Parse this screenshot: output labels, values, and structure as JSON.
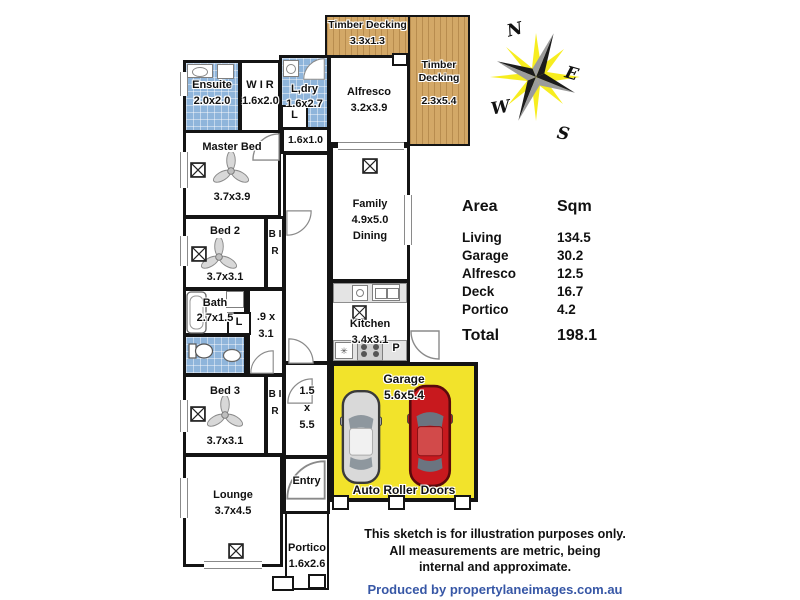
{
  "plan": {
    "deck_top": {
      "name": "Timber Decking",
      "dims": "3.3x1.3"
    },
    "deck_right": {
      "name": "Timber Decking",
      "dims": "2.3x5.4"
    },
    "alfresco": {
      "name": "Alfresco",
      "dims": "3.2x3.9"
    },
    "ensuite": {
      "name": "Ensuite",
      "dims": "2.0x2.0"
    },
    "wir": {
      "name": "W I R",
      "dims": "1.6x2.0"
    },
    "ldry": {
      "name": "L,dry",
      "dims": "1.6x2.7"
    },
    "linen1": {
      "name": "L"
    },
    "hall_a": {
      "dims": "1.6x1.0"
    },
    "master": {
      "name": "Master Bed",
      "dims": "3.7x3.9"
    },
    "family": {
      "name": "Family",
      "dims": "4.9x5.0",
      "extra": "Dining"
    },
    "bed2": {
      "name": "Bed 2",
      "dims": "3.7x3.1"
    },
    "bir1": {
      "name": "B I R"
    },
    "bath": {
      "name": "Bath",
      "dims": "2.7x1.5"
    },
    "linen2": {
      "name": "L"
    },
    "hall_b": {
      "dims": ".9 x 3.1"
    },
    "kitchen": {
      "name": "Kitchen",
      "dims": "3.4x3.1",
      "pantry": "P",
      "fridge_glyph": "✳"
    },
    "bed3": {
      "name": "Bed 3",
      "dims": "3.7x3.1"
    },
    "bir2": {
      "name": "B I R"
    },
    "hall_c": {
      "dims": "1.5 x 5.5"
    },
    "entry": {
      "name": "Entry"
    },
    "lounge": {
      "name": "Lounge",
      "dims": "3.7x4.5"
    },
    "portico": {
      "name": "Portico",
      "dims": "1.6x2.6"
    },
    "garage": {
      "name": "Garage",
      "dims": "5.6x5.4",
      "doors_label": "Auto Roller Doors"
    }
  },
  "compass": {
    "n": "N",
    "e": "E",
    "s": "S",
    "w": "W"
  },
  "area_table": {
    "col1": "Area",
    "col2": "Sqm",
    "rows": [
      {
        "label": "Living",
        "value": "134.5"
      },
      {
        "label": "Garage",
        "value": "30.2"
      },
      {
        "label": "Alfresco",
        "value": "12.5"
      },
      {
        "label": "Deck",
        "value": "16.7"
      },
      {
        "label": "Portico",
        "value": "4.2"
      }
    ],
    "total_label": "Total",
    "total_value": "198.1"
  },
  "footer": {
    "line1": "This sketch is for illustration purposes only.",
    "line2": "All measurements are metric, being",
    "line3": "internal and approximate.",
    "credit": "Produced by propertylaneimages.com.au"
  },
  "icons": {
    "window": "boxed-x-window",
    "fan": "ceiling-fan",
    "door": "quarter-arc-door",
    "compass": "compass-rose-starburst",
    "cars": [
      "silver-car-top-view",
      "red-car-top-view"
    ]
  },
  "colors": {
    "wall": "#141414",
    "wet_area_tile": "#8fb5db",
    "timber_deck": "#d3a867",
    "garage_floor": "#f2e32b",
    "car_red": "#c8191e",
    "car_silver": "#d6d6d6",
    "compass_yellow": "#f7ec13",
    "credit_blue": "#3757a6"
  }
}
